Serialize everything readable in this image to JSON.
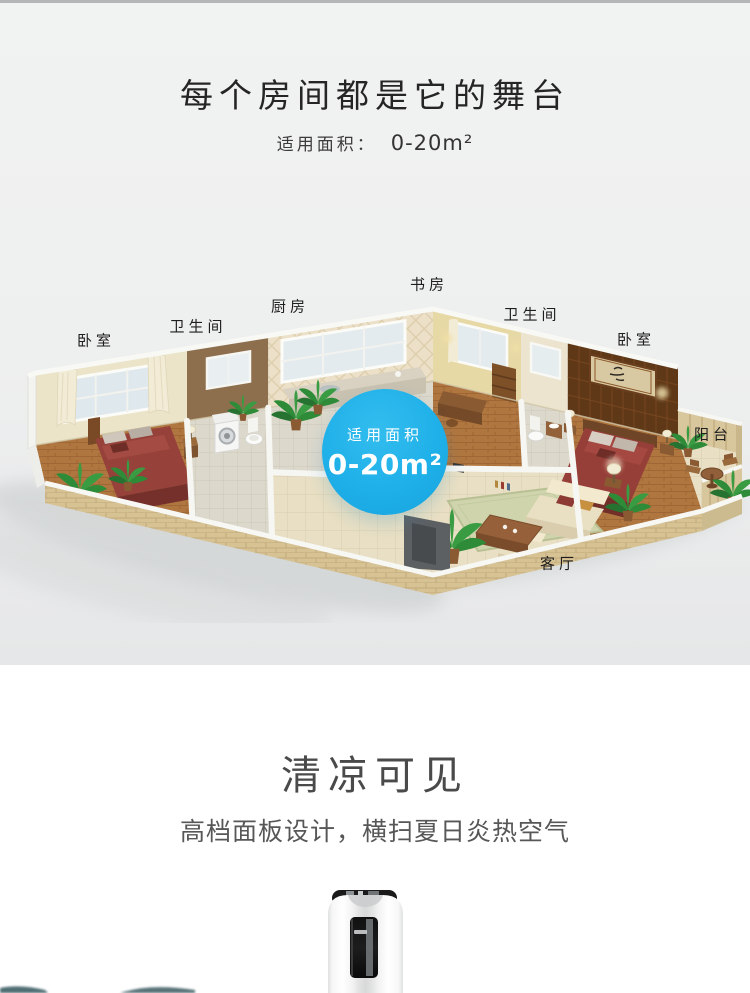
{
  "hero": {
    "title": "每个房间都是它的舞台",
    "area_label": "适用面积：",
    "area_value": "0-20m²"
  },
  "floorplan": {
    "labels": [
      {
        "id": "bedroom-left",
        "text": "卧室"
      },
      {
        "id": "bathroom-left",
        "text": "卫生间"
      },
      {
        "id": "kitchen",
        "text": "厨房"
      },
      {
        "id": "study",
        "text": "书房"
      },
      {
        "id": "bathroom-right",
        "text": "卫生间"
      },
      {
        "id": "bedroom-right",
        "text": "卧室"
      },
      {
        "id": "balcony",
        "text": "阳台"
      },
      {
        "id": "living-room",
        "text": "客厅"
      }
    ],
    "badge": {
      "line1": "适用面积",
      "line2": "0-20m²",
      "color": "#1fb0e9"
    }
  },
  "cooling": {
    "title": "清凉可见",
    "subtitle": "高档面板设计，横扫夏日炎热空气"
  }
}
